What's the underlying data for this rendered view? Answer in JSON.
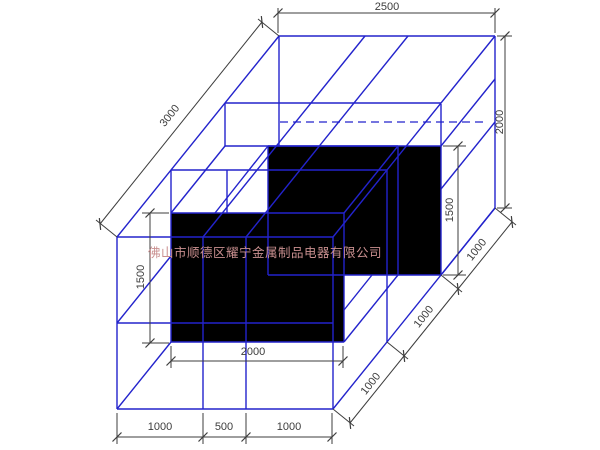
{
  "watermark": {
    "text": "佛山市顺德区耀宁金属制品电器有限公司",
    "color": "#c98f8f",
    "font_size": 12.5,
    "x": 265,
    "y": 257
  },
  "colors": {
    "wire": "#2323cc",
    "hidden": "#2323cc",
    "solid_fill": "#000000",
    "dim": "#3d3d3d",
    "background": "#ffffff"
  },
  "drawing": {
    "width": 600,
    "height": 450,
    "solid_faces": [
      {
        "name": "front-box-face",
        "points": "171,213 344,213 344,342 171,342"
      },
      {
        "name": "back-box-face",
        "points": "268,146 441,146 441,275 268,275"
      }
    ],
    "wire_lines": [
      [
        279,
        36,
        495,
        36
      ],
      [
        495,
        36,
        495,
        208
      ],
      [
        279,
        36,
        117,
        237
      ],
      [
        495,
        208,
        333,
        409
      ],
      [
        117,
        237,
        117,
        409
      ],
      [
        117,
        409,
        333,
        409
      ],
      [
        117,
        237,
        333,
        237
      ],
      [
        333,
        237,
        333,
        409
      ],
      [
        279,
        36,
        279,
        146
      ],
      [
        117,
        409,
        171,
        342
      ],
      [
        495,
        36,
        333,
        237
      ],
      [
        365,
        36,
        203,
        237
      ],
      [
        408,
        36,
        246,
        237
      ],
      [
        225,
        103,
        441,
        103
      ],
      [
        171,
        170,
        387,
        170
      ],
      [
        203,
        237,
        203,
        409
      ],
      [
        246,
        237,
        246,
        409
      ],
      [
        117,
        323,
        333,
        323
      ],
      [
        441,
        104,
        441,
        275
      ],
      [
        387,
        170,
        387,
        342
      ],
      [
        495,
        122,
        441,
        189
      ],
      [
        372,
        275,
        344,
        310
      ],
      [
        171,
        213,
        344,
        213
      ],
      [
        171,
        213,
        171,
        342
      ],
      [
        344,
        213,
        344,
        342
      ],
      [
        171,
        342,
        344,
        342
      ],
      [
        171,
        213,
        225,
        146
      ],
      [
        344,
        213,
        398,
        146
      ],
      [
        225,
        146,
        398,
        146
      ],
      [
        344,
        342,
        398,
        275
      ],
      [
        398,
        146,
        398,
        275
      ],
      [
        268,
        146,
        441,
        146
      ],
      [
        268,
        146,
        268,
        275
      ],
      [
        268,
        275,
        441,
        275
      ],
      [
        441,
        146,
        495,
        79
      ],
      [
        441,
        275,
        495,
        208
      ],
      [
        215,
        213,
        268,
        146
      ],
      [
        227,
        170,
        227,
        213
      ],
      [
        225,
        103,
        225,
        146
      ],
      [
        117,
        323,
        171,
        256
      ],
      [
        171,
        170,
        171,
        213
      ]
    ],
    "hidden_lines": [
      [
        280,
        122,
        488,
        122
      ]
    ],
    "dimensions": [
      {
        "label": "2500",
        "line": [
          278,
          13,
          495,
          13
        ],
        "exts": [
          [
            278,
            8,
            278,
            33
          ],
          [
            495,
            8,
            495,
            33
          ]
        ],
        "ticks": [
          [
            278,
            13
          ],
          [
            495,
            13
          ]
        ],
        "text": [
          387,
          7
        ],
        "rot": 0,
        "diag": false
      },
      {
        "label": "3000",
        "line": [
          262,
          22,
          100,
          224
        ],
        "exts": [
          [
            279,
            36,
            258,
            19
          ],
          [
            117,
            237,
            96,
            220
          ]
        ],
        "ticks": [
          [
            262,
            22
          ],
          [
            100,
            224
          ]
        ],
        "text": [
          170,
          116
        ],
        "rot": -51.5,
        "diag": true
      },
      {
        "label": "2000",
        "line": [
          505,
          36,
          505,
          208
        ],
        "exts": [
          [
            497,
            36,
            512,
            36
          ],
          [
            497,
            208,
            512,
            208
          ]
        ],
        "ticks": [
          [
            505,
            36
          ],
          [
            505,
            208
          ]
        ],
        "text": [
          500,
          122
        ],
        "rot": -90,
        "diag": false
      },
      {
        "label": "1500",
        "line": [
          458,
          146,
          458,
          275
        ],
        "exts": [
          [
            443,
            146,
            466,
            146
          ],
          [
            443,
            275,
            466,
            275
          ]
        ],
        "ticks": [
          [
            458,
            146
          ],
          [
            458,
            275
          ]
        ],
        "text": [
          450,
          210
        ],
        "rot": -90,
        "diag": false
      },
      {
        "label": "1500",
        "line": [
          150,
          213,
          150,
          343
        ],
        "exts": [
          [
            169,
            213,
            142,
            213
          ],
          [
            169,
            343,
            142,
            343
          ]
        ],
        "ticks": [
          [
            150,
            213
          ],
          [
            150,
            343
          ]
        ],
        "text": [
          141,
          277
        ],
        "rot": -90,
        "diag": false
      },
      {
        "label": "2000",
        "line": [
          171,
          361,
          343,
          361
        ],
        "exts": [
          [
            171,
            346,
            171,
            368
          ],
          [
            343,
            346,
            343,
            368
          ]
        ],
        "ticks": [
          [
            171,
            361
          ],
          [
            343,
            361
          ]
        ],
        "text": [
          253,
          352
        ],
        "rot": 0,
        "diag": false
      },
      {
        "label": "1000",
        "line": [
          117,
          437,
          203,
          437
        ],
        "exts": [
          [
            117,
            413,
            117,
            444
          ],
          [
            203,
            413,
            203,
            444
          ]
        ],
        "ticks": [
          [
            117,
            437
          ],
          [
            203,
            437
          ]
        ],
        "text": [
          160,
          427
        ],
        "rot": 0,
        "diag": false
      },
      {
        "label": "500",
        "line": [
          203,
          437,
          246,
          437
        ],
        "exts": [
          [
            246,
            413,
            246,
            444
          ]
        ],
        "ticks": [
          [
            246,
            437
          ]
        ],
        "text": [
          224,
          427
        ],
        "rot": 0,
        "diag": false
      },
      {
        "label": "1000",
        "line": [
          246,
          437,
          332,
          437
        ],
        "exts": [
          [
            332,
            413,
            332,
            444
          ]
        ],
        "ticks": [
          [
            332,
            437
          ]
        ],
        "text": [
          289,
          427
        ],
        "rot": 0,
        "diag": false
      },
      {
        "label": "1000",
        "line": [
          512,
          222,
          458,
          289
        ],
        "exts": [
          [
            495,
            208,
            516,
            225
          ],
          [
            441,
            275,
            462,
            292
          ]
        ],
        "ticks": [
          [
            512,
            222
          ],
          [
            458,
            289
          ]
        ],
        "text": [
          477,
          250
        ],
        "rot": -51.5,
        "diag": true
      },
      {
        "label": "1000",
        "line": [
          458,
          289,
          404,
          356
        ],
        "exts": [
          [
            387,
            342,
            408,
            359
          ]
        ],
        "ticks": [
          [
            404,
            356
          ]
        ],
        "text": [
          424,
          317
        ],
        "rot": -51.5,
        "diag": true
      },
      {
        "label": "1000",
        "line": [
          404,
          356,
          350,
          423
        ],
        "exts": [
          [
            333,
            409,
            354,
            426
          ]
        ],
        "ticks": [
          [
            350,
            423
          ]
        ],
        "text": [
          371,
          384
        ],
        "rot": -51.5,
        "diag": true
      }
    ]
  }
}
